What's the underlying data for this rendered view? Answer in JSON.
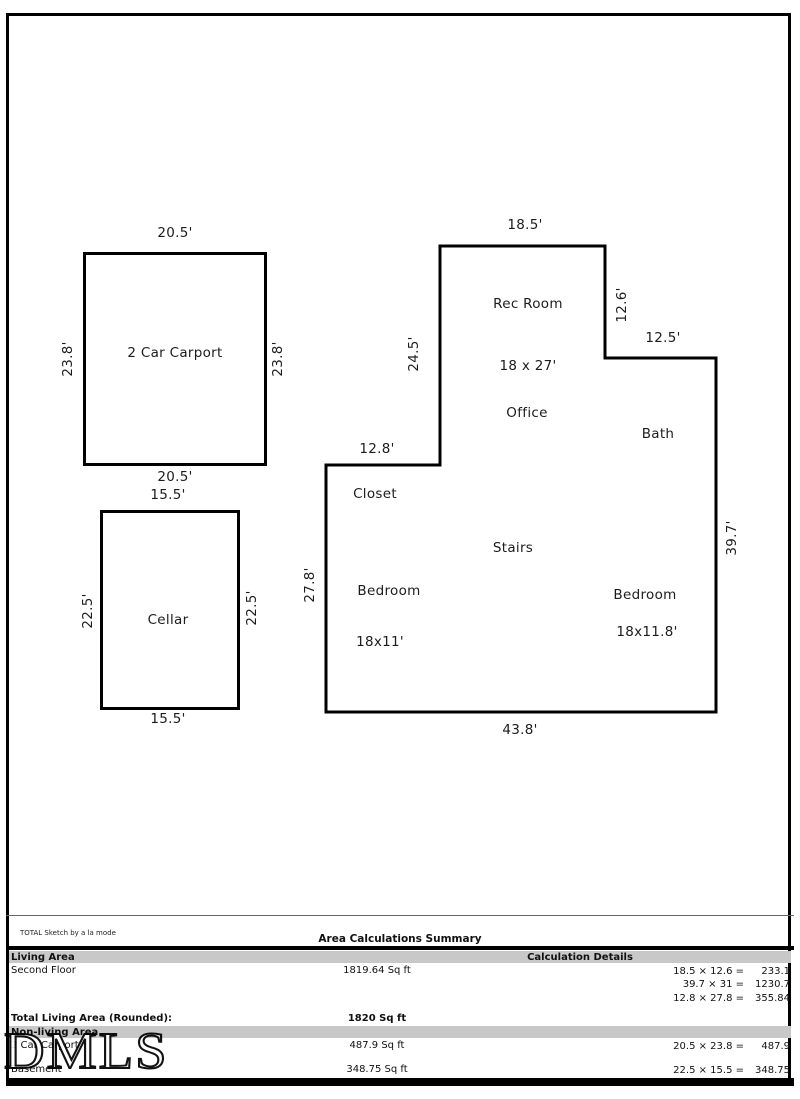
{
  "page": {
    "branding": "TOTAL Sketch by a la mode",
    "watermark": "DMLS"
  },
  "floorplan": {
    "carport": {
      "name": "2 Car Carport",
      "dim_top": "20.5'",
      "dim_bottom": "20.5'",
      "dim_left": "23.8'",
      "dim_right": "23.8'"
    },
    "cellar": {
      "name": "Cellar",
      "dim_top": "15.5'",
      "dim_bottom": "15.5'",
      "dim_left": "22.5'",
      "dim_right": "22.5'"
    },
    "second_floor": {
      "dim_top": "18.5'",
      "dim_right_upper": "12.6'",
      "dim_right_offset": "12.5'",
      "dim_right": "39.7'",
      "dim_bottom": "43.8'",
      "dim_left": "27.8'",
      "dim_left_offset": "12.8'",
      "dim_left_upper": "24.5'",
      "room_rec": "Rec Room",
      "room_rec_size": "18 x 27'",
      "room_office": "Office",
      "room_bath": "Bath",
      "room_closet": "Closet",
      "room_stairs": "Stairs",
      "room_bedroom_left": "Bedroom",
      "room_bedroom_left_size": "18x11'",
      "room_bedroom_right": "Bedroom",
      "room_bedroom_right_size": "18x11.8'"
    }
  },
  "summary": {
    "title": "Area Calculations Summary",
    "living_header": "Living Area",
    "details_header": "Calculation Details",
    "living_rows": [
      {
        "label": "Second Floor",
        "area": "1819.64 Sq ft"
      }
    ],
    "living_calcs": [
      {
        "expr": "18.5 × 12.6 =",
        "result": "233.1"
      },
      {
        "expr": "39.7 × 31 =",
        "result": "1230.7"
      },
      {
        "expr": "12.8 × 27.8 =",
        "result": "355.84"
      }
    ],
    "total_label": "Total Living Area (Rounded):",
    "total_value": "1820 Sq ft",
    "nonliving_header": "Non-living Area",
    "nonliving_rows": [
      {
        "label": "2 Car Carport",
        "area": "487.9 Sq ft",
        "expr": "20.5 × 23.8 =",
        "result": "487.9"
      },
      {
        "label": "Basement",
        "area": "348.75 Sq ft",
        "expr": "22.5 × 15.5 =",
        "result": "348.75"
      }
    ]
  }
}
